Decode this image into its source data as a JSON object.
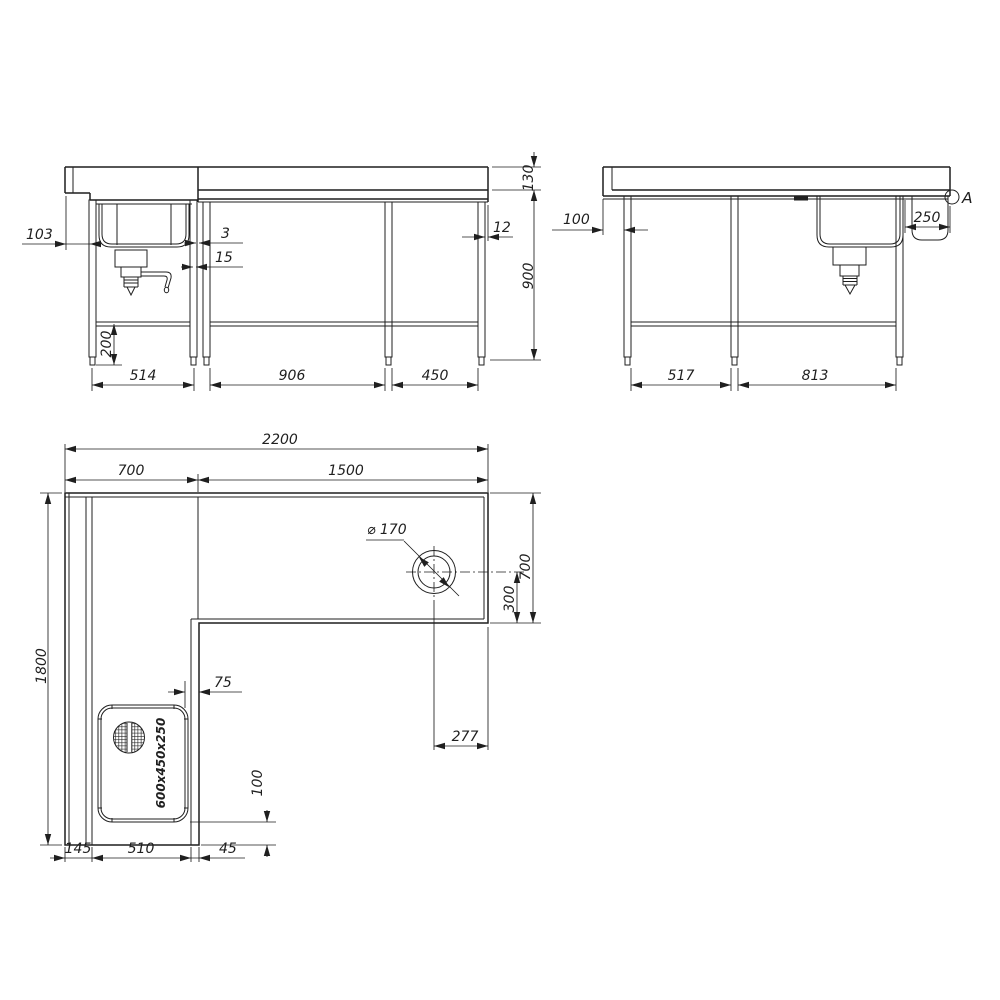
{
  "drawing": {
    "type": "technical-drawing",
    "subject": "L-shaped corner sink counter unit, three orthographic views",
    "line_color": "#1f1f1f",
    "background": "#ffffff"
  },
  "views": {
    "front": {
      "label": "front elevation",
      "dims": {
        "backsplash_height": "130",
        "working_height": "900",
        "left_overhang": "103",
        "top_gap": "3",
        "leg_gap": "15",
        "edge_offset": "12",
        "shelf_height": "200",
        "bay_left": "514",
        "bay_center": "906",
        "bay_right": "450"
      }
    },
    "side": {
      "label": "side elevation",
      "detail_marker": "A",
      "dims": {
        "end_overhang": "100",
        "sink_offset": "250",
        "bay_left": "517",
        "bay_right": "813"
      }
    },
    "plan": {
      "label": "plan view",
      "sink_size_label": "600x450x250",
      "dims": {
        "total_length": "2200",
        "section_left": "700",
        "section_right": "1500",
        "depth_total": "1800",
        "depth_right": "700",
        "hole_offset_y": "300",
        "hole_diameter": "⌀ 170",
        "hole_offset_x": "277",
        "sink_edge_gap": "75",
        "sink_bottom_gap": "100",
        "back_strip": "145",
        "sink_bay": "510",
        "front_strip": "45"
      }
    }
  }
}
